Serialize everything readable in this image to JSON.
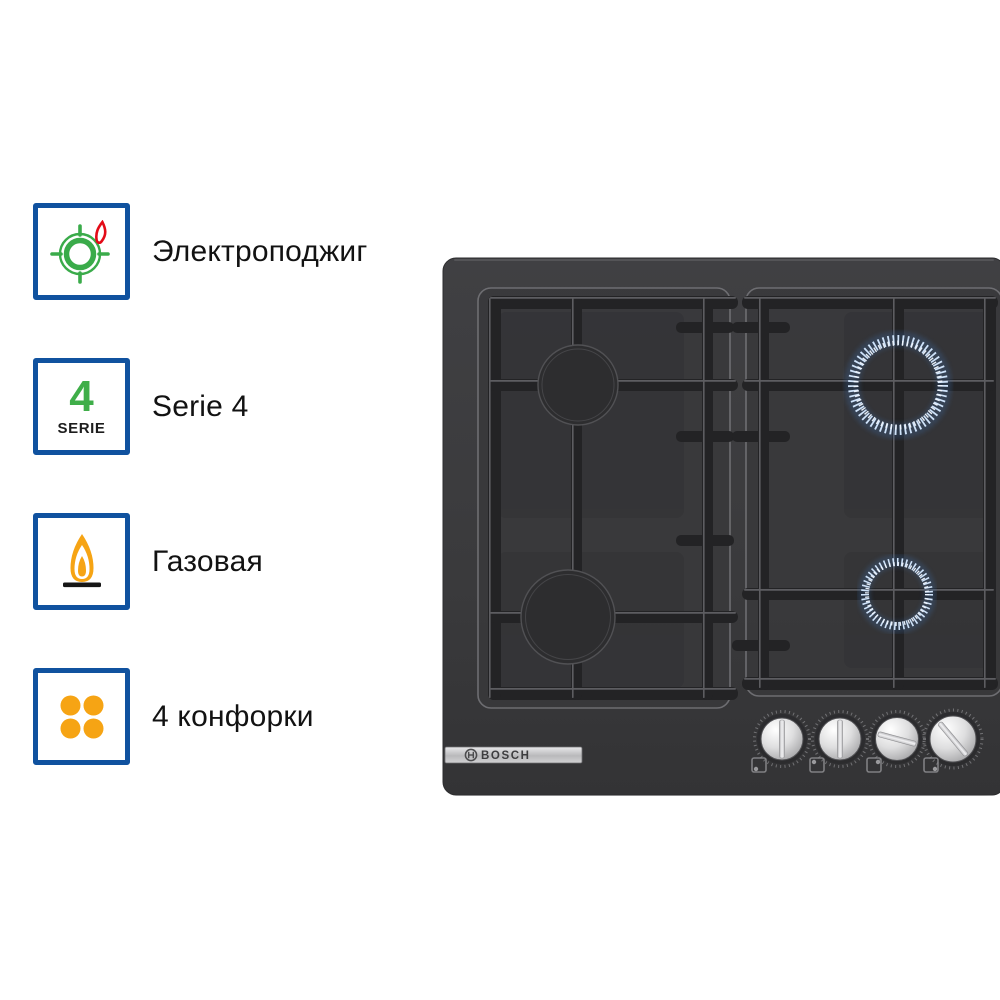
{
  "features": [
    {
      "label": "Электроподжиг",
      "icon": "ignition-burner-icon"
    },
    {
      "label": "Serie 4",
      "badge_number": "4",
      "badge_caption": "SERIE"
    },
    {
      "label": "Газовая",
      "icon": "gas-flame-icon"
    },
    {
      "label": "4 конфорки",
      "icon": "four-burners-icon"
    }
  ],
  "product": {
    "brand": "BOSCH",
    "burners_total": 4,
    "burners_lit": 2,
    "knobs": 4
  },
  "colors": {
    "badge_border_blue": "#10529f",
    "icon_green": "#3aab4a",
    "icon_red": "#e30b17",
    "icon_orange": "#f6a414",
    "flame_blue": "#a9cdf2",
    "hob_body": "#3b3b3d",
    "grate_dark": "#252527",
    "background": "#ffffff"
  }
}
